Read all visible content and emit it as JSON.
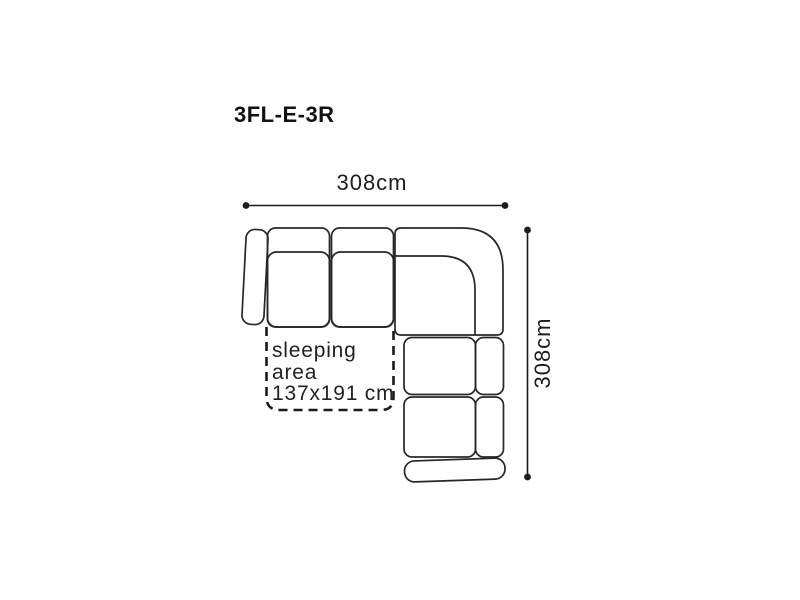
{
  "title": "3FL-E-3R",
  "dimensions": {
    "width": "308cm",
    "height": "308cm"
  },
  "sleeping_area": {
    "line1": "sleeping",
    "line2": "area",
    "line3": "137x191 cm"
  },
  "colors": {
    "outline": "#272727",
    "text": "#1d1d1d",
    "background": "#ffffff"
  }
}
